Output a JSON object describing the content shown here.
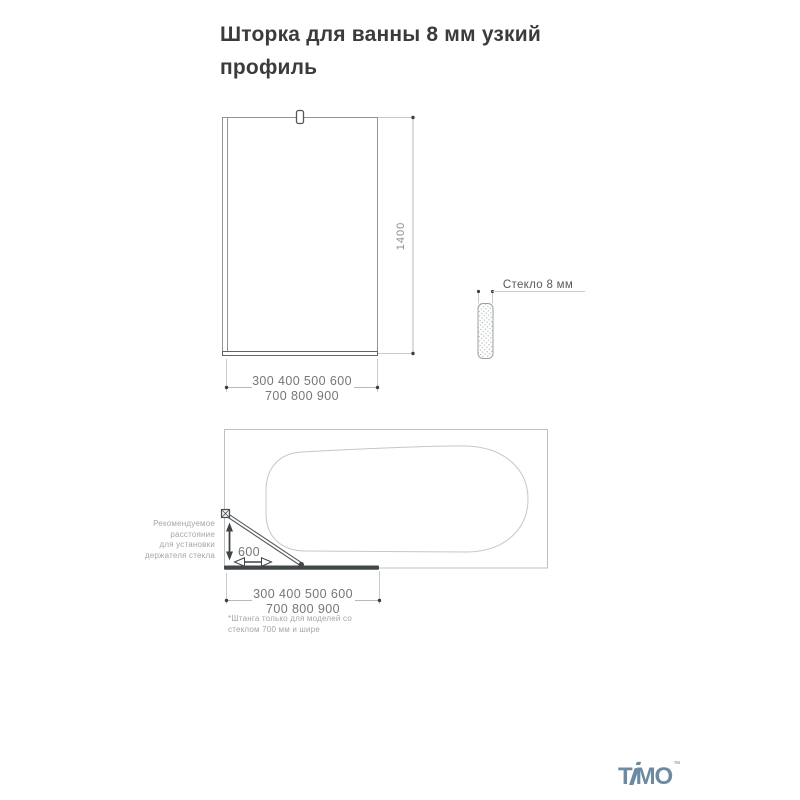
{
  "title": {
    "text": "Шторка для ванны 8 мм узкий\nпрофиль"
  },
  "front_view": {
    "height_label": "1400",
    "width_line1": "300 400 500 600",
    "width_line2": "700 800 900"
  },
  "side_view": {
    "glass_thickness_label": "Стекло 8 мм"
  },
  "top_view": {
    "distance_label": "600",
    "holder_note": "Рекомендуемое\nрасстояние\nдля установки\nдержателя стекла",
    "width_line1": "300 400 500 600",
    "width_line2": "700 800 900",
    "footnote": "*Штанга только для моделей со\nстеклом 700 мм и шире"
  },
  "logo": {
    "t": "T",
    "i": "i",
    "mo": "MO",
    "trademark": "™"
  },
  "colors": {
    "title_text": "#3b3b3b",
    "dimension_text": "#767676",
    "note_text": "#a5a5a5",
    "line_light": "#c6cacc",
    "line_medium": "#9aa0a4",
    "dark_elements": "#42474a",
    "logo": "#6d8ba0"
  }
}
